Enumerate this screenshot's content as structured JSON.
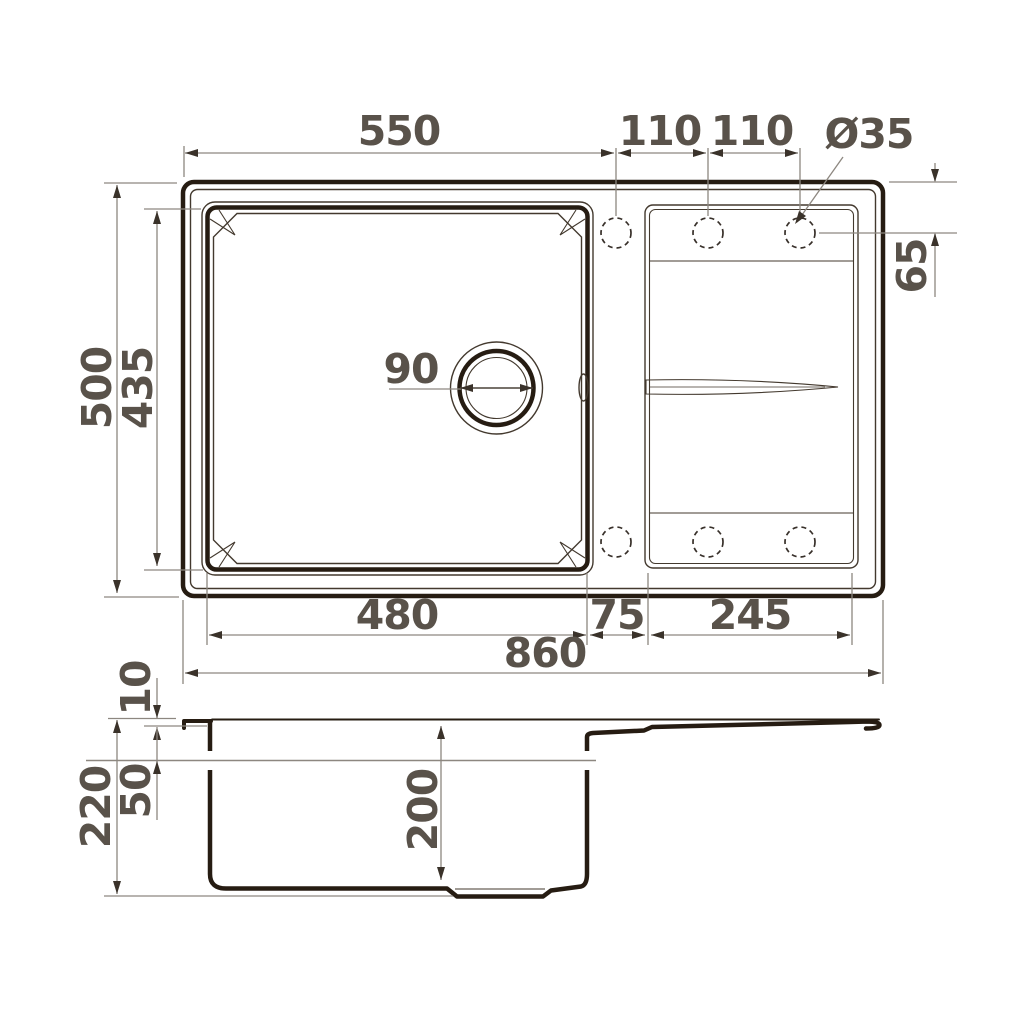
{
  "drawing": {
    "type": "sink-technical-drawing",
    "views": [
      "top-view",
      "side-section-view"
    ],
    "colors": {
      "outline_dark": "#261c12",
      "line_thin": "#43392e",
      "dimension_line": "#8d8780",
      "label_text": "#59524a",
      "background": "#ffffff"
    }
  },
  "dims": {
    "bowl_rim_width": "550",
    "hole_pitch_1": "110",
    "hole_pitch_2": "110",
    "hole_diameter": "Ø35",
    "overall_depth": "500",
    "bowl_outer_depth": "435",
    "hole_offset": "65",
    "drain_diameter": "90",
    "bowl_base_width": "480",
    "bowl_drainboard_gap": "75",
    "drainboard_width": "245",
    "overall_width": "860",
    "rim_height": "10",
    "ledge_depth": "50",
    "overall_height": "220",
    "bowl_depth": "200"
  }
}
